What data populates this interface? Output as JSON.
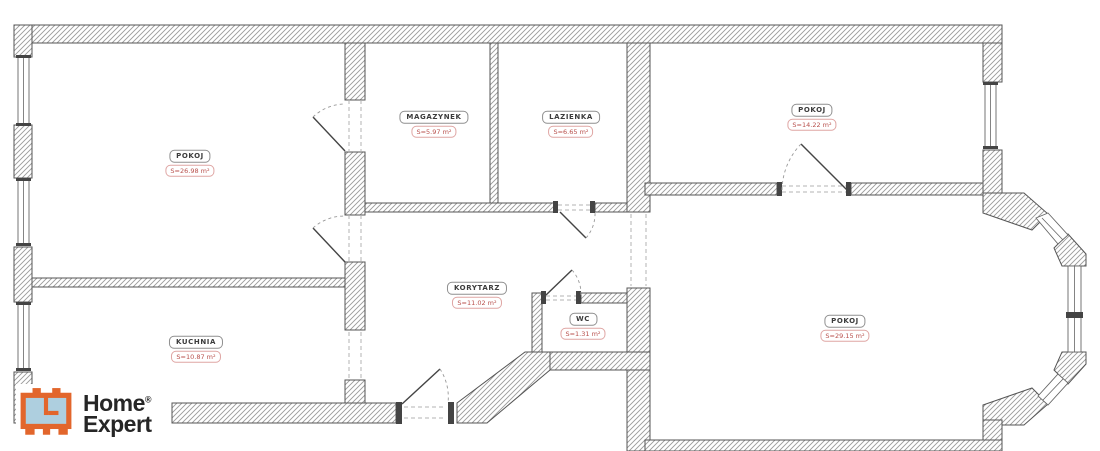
{
  "plan": {
    "type": "floor-plan",
    "rooms": [
      {
        "id": "pokoj-1",
        "name": "POKOJ",
        "area": "S=26.98 m²"
      },
      {
        "id": "magazynek",
        "name": "MAGAZYNEK",
        "area": "S=5.97 m²"
      },
      {
        "id": "lazienka",
        "name": "LAZIENKA",
        "area": "S=6.65 m²"
      },
      {
        "id": "pokoj-2",
        "name": "POKOJ",
        "area": "S=14.22 m²"
      },
      {
        "id": "korytarz",
        "name": "KORYTARZ",
        "area": "S=11.02 m²"
      },
      {
        "id": "wc",
        "name": "WC",
        "area": "S=1.31 m²"
      },
      {
        "id": "kuchnia",
        "name": "KUCHNIA",
        "area": "S=10.87 m²"
      },
      {
        "id": "pokoj-3",
        "name": "POKOJ",
        "area": "S=29.15 m²"
      }
    ]
  },
  "logo": {
    "line1": "Home",
    "line2": "Expert",
    "registered": "®"
  },
  "colors": {
    "wall_hatch": "#9a9a9a",
    "wall_outline": "#555555",
    "area_text": "#b8504c",
    "logo_orange": "#e2662c",
    "logo_blue": "#aecfdf",
    "logo_text": "#262626"
  }
}
